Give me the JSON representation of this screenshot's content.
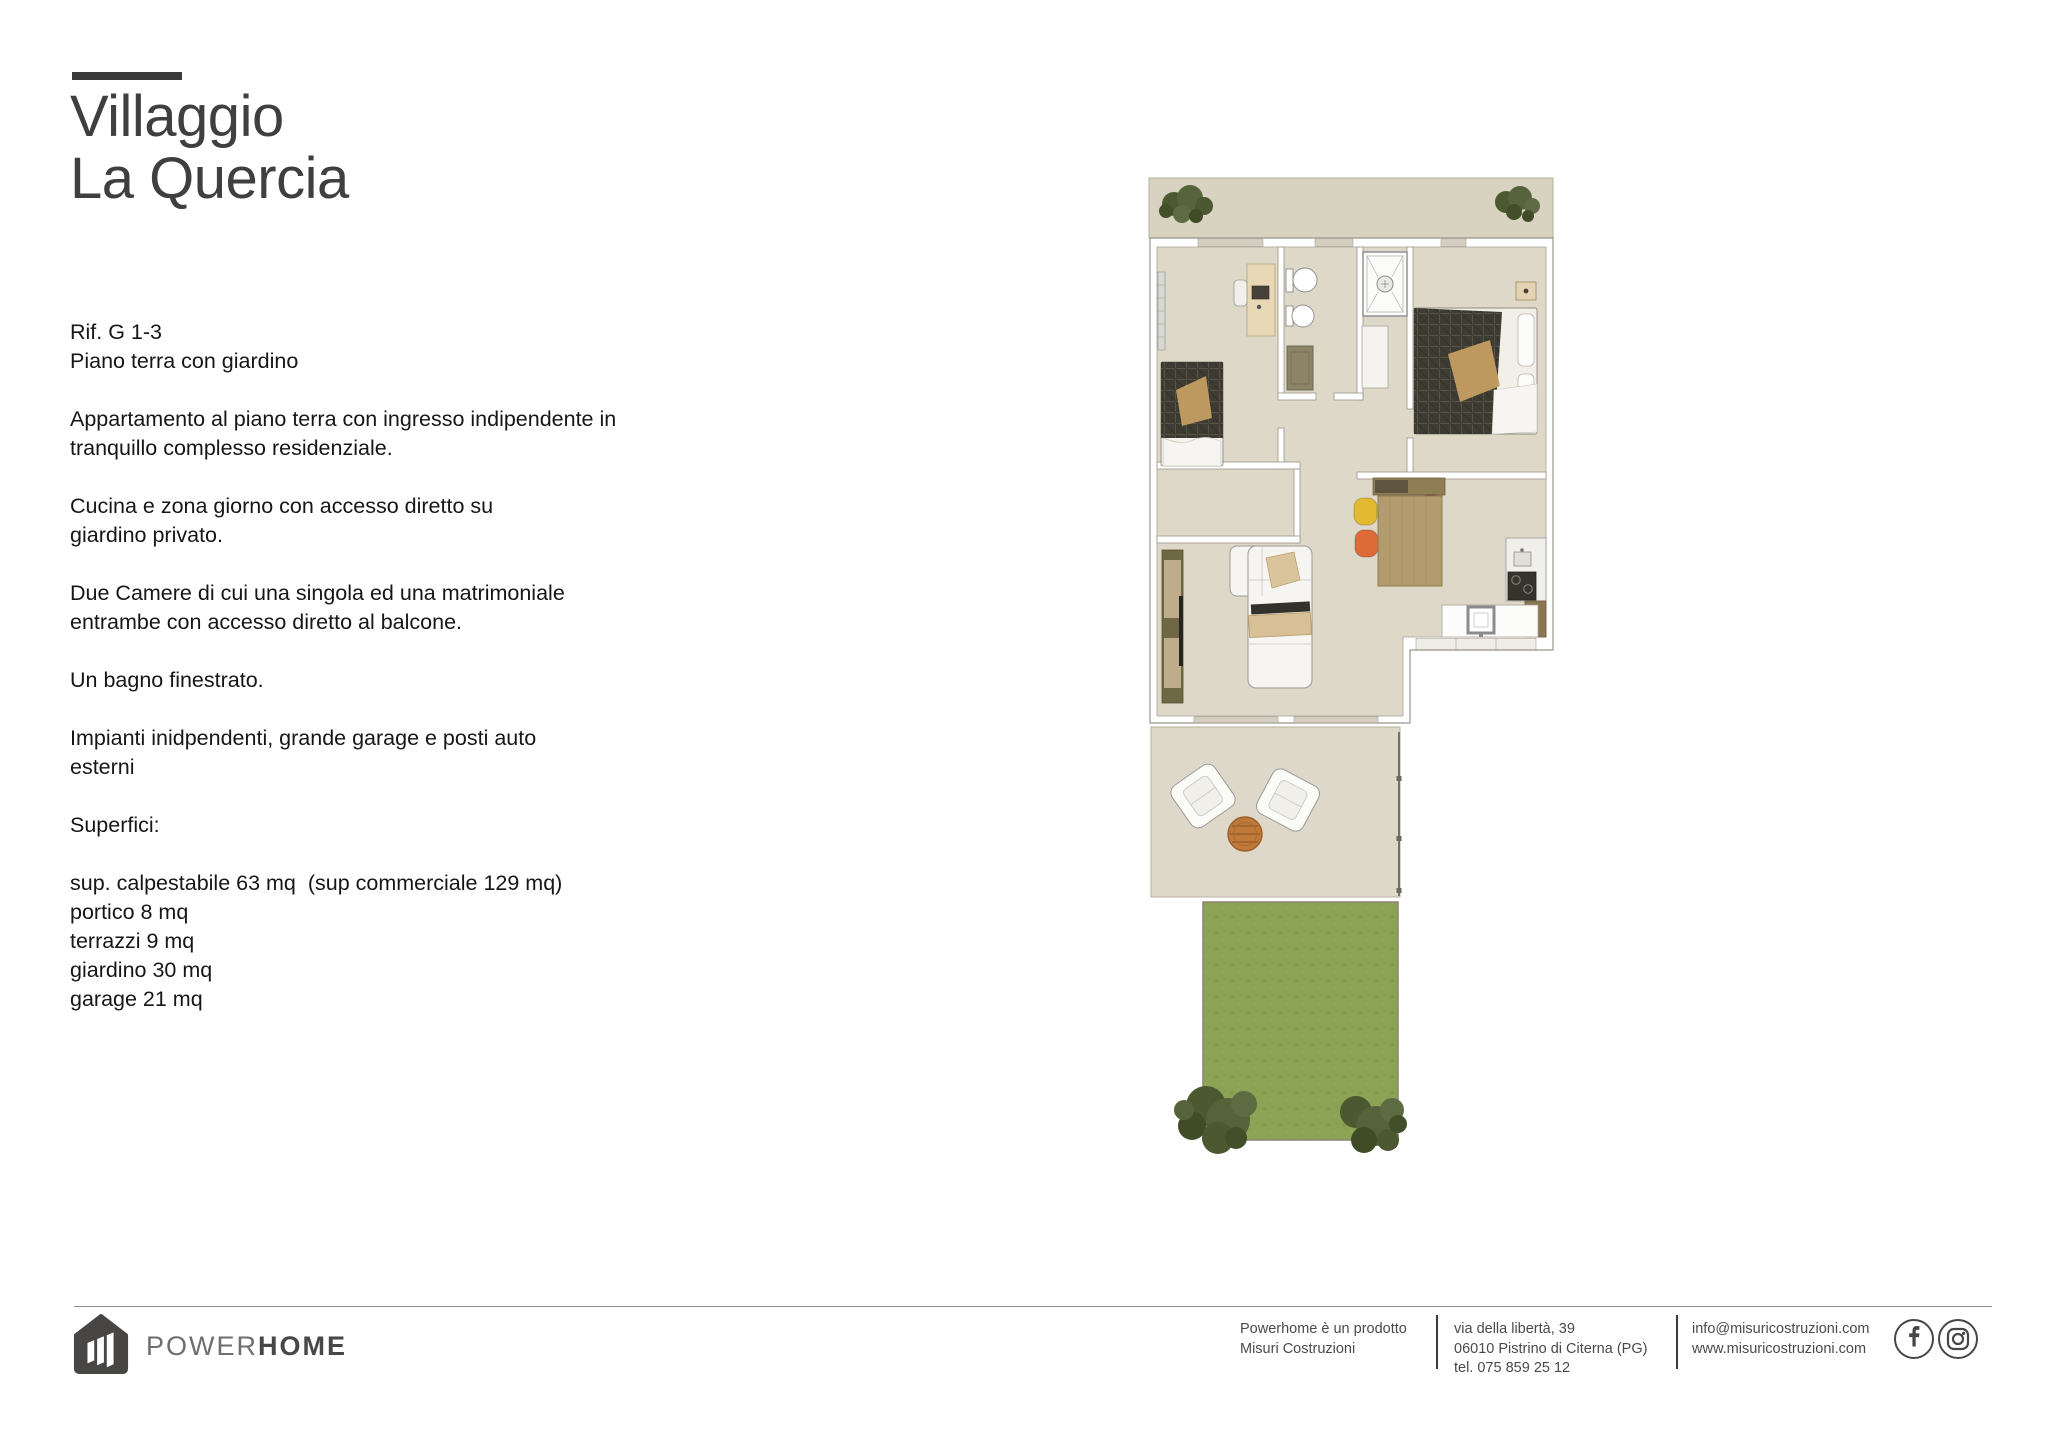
{
  "title": {
    "line1": "Villaggio",
    "line2": "La Quercia"
  },
  "description": {
    "paragraphs": [
      "Rif. G 1-3\nPiano terra con giardino",
      "Appartamento al piano terra con ingresso indipendente in\ntranquillo complesso residenziale.",
      "Cucina e zona giorno con accesso diretto su\ngiardino privato.",
      "Due Camere di cui una singola ed una matrimoniale\nentrambe con accesso diretto al balcone.",
      "Un bagno finestrato.",
      "Impianti inidpendenti, grande garage e posti auto\nesterni",
      "Superfici:",
      "sup. calpestabile 63 mq  (sup commerciale 129 mq)\nportico 8 mq\nterrazzi 9 mq\ngiardino 30 mq\ngarage 21 mq"
    ]
  },
  "brand": {
    "power": "POWER",
    "home": "HOME"
  },
  "footer": {
    "col1": [
      "Powerhome è un prodotto",
      "Misuri Costruzioni"
    ],
    "col2": [
      "via della libertà, 39",
      "06010 Pistrino di Citerna (PG)",
      "tel. 075 859 25 12"
    ],
    "col3": [
      "info@misuricostruzioni.com",
      "www.misuricostruzioni.com"
    ],
    "social": [
      "facebook",
      "instagram"
    ]
  },
  "colors": {
    "ink": "#3f3f3f",
    "body-ink": "#161616",
    "rule": "#3a3a3a",
    "divider": "#909090",
    "footer-ink": "#4a4a4a",
    "floor": "#ddd8c8",
    "balcony": "#d8d2c0",
    "patio": "#ddd8ca",
    "lawn": "#8ca355",
    "wall-line": "#9b958a",
    "tree": "#4c5830",
    "wood": "#b29b6d",
    "chair-yellow": "#e2b930",
    "chair-red": "#b2424e",
    "chair-orange": "#de6a37",
    "chair-green": "#a9c25f"
  }
}
